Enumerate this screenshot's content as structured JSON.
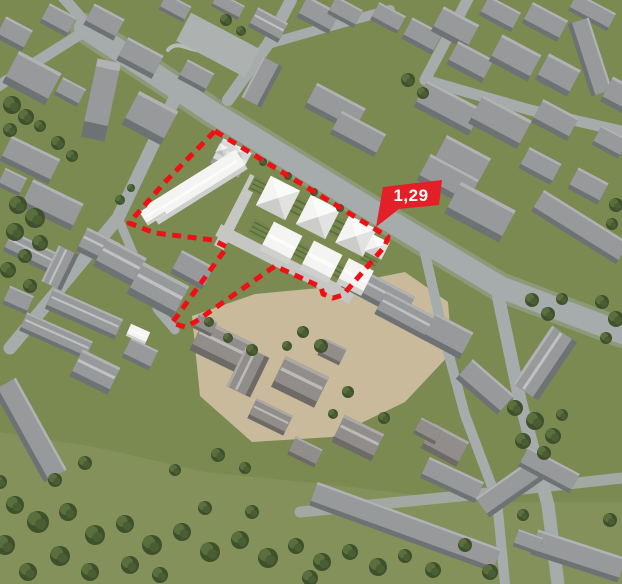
{
  "app": {
    "type": "3d-aerial-site-render",
    "canvas_width": 622,
    "canvas_height": 584,
    "description": "Aerial axonometric render of an urban district. A red dashed boundary outlines a development site containing white proposed buildings (one long slab and seven hipped/flat-roof houses) among existing grey buildings, roads, a tan campus courtyard, lawns and trees. A red flag callout labels the site area."
  },
  "callout": {
    "label": "1,29",
    "bg_color": "#e31f27",
    "text_color": "#ffffff",
    "tip_points_to": "north-east corner of the site boundary"
  },
  "site_boundary": {
    "stroke_color": "#f00f14",
    "stroke_style": "dashed",
    "points": [
      [
        215,
        131
      ],
      [
        388,
        237
      ],
      [
        385,
        246
      ],
      [
        343,
        295
      ],
      [
        333,
        298
      ],
      [
        323,
        294
      ],
      [
        321,
        287
      ],
      [
        275,
        266
      ],
      [
        195,
        322
      ],
      [
        185,
        327
      ],
      [
        172,
        323
      ],
      [
        227,
        247
      ],
      [
        213,
        240
      ],
      [
        155,
        233
      ],
      [
        129,
        223
      ],
      [
        165,
        182
      ]
    ]
  },
  "colors": {
    "grass": "#7a8a51",
    "grass_light": "#85915a",
    "road": "#a6abab",
    "road_minor": "#b0b5b3",
    "pavement_tan": "#cdbda0",
    "inner_lane": "#c6c7c3",
    "existing_roof": "#97999a",
    "existing_wall": "#6f7274",
    "campus_roof": "#908d8a",
    "campus_wall": "#6e6a67",
    "proposed_roof": "#f4f4f2",
    "proposed_wall": "#d3d5d5",
    "historic_roof": "#d6d7d7",
    "tree_dark": "#3e512c",
    "tree_mid": "#5a6e3e",
    "white_shed": "#f6f6f4"
  }
}
